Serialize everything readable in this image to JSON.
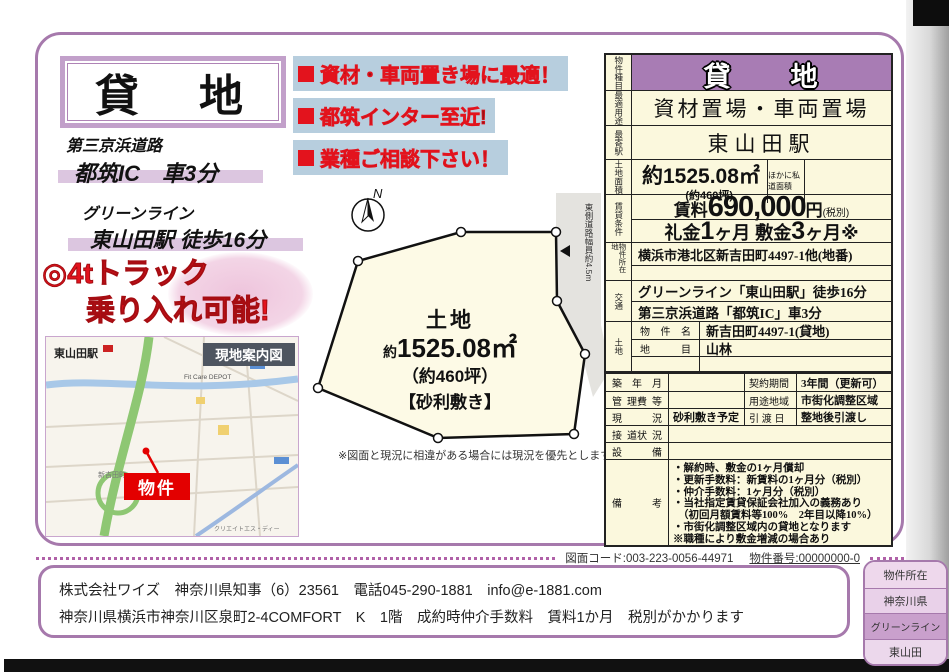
{
  "header": {
    "title": "貸　地"
  },
  "bullets": {
    "items": [
      "資材・車両置き場に最適！",
      "都筑インター至近!",
      "業種ご相談下さい！"
    ]
  },
  "access": {
    "road_line1": "第三京浜道路",
    "road_line2": "都筑IC　車3分",
    "rail_line1": "グリーンライン",
    "rail_line2": "東山田駅 徒歩16分",
    "truck_line1": "◎4tトラック",
    "truck_line2": "乗り入れ可能!"
  },
  "map": {
    "title": "現地案内図",
    "station": "東山田駅",
    "store": "Fit Care DEPOT",
    "area": "新吉田町",
    "poi": "クリエイトエス・ディー",
    "poi2": "オーケー",
    "marker": "物件"
  },
  "plot": {
    "north": "N",
    "name": "土地",
    "area_prefix": "約",
    "area_value": "1525.08㎡",
    "tsubo": "（約460坪）",
    "surface": "【砂利敷き】",
    "road_label": "東側道路幅員約4.5m",
    "note": "※図面と現況に相違がある場合には現況を優先とします。"
  },
  "table": {
    "type_label": "物件種目",
    "type_value": "貸　　地",
    "use_label": "最適用途",
    "use_value": "資材置場・車両置場",
    "station_label": "最寄駅",
    "station_value": "東山田駅",
    "area_label": "土地面積",
    "area_value": "約1525.08㎡",
    "area_tsubo": "(約460坪)",
    "area_other": "ほかに私道面積",
    "rent_label": "賃貸条件",
    "rent_prefix": "賃料",
    "rent_amount": "690,000",
    "rent_unit": "円",
    "rent_tax": "(税別)",
    "key_label": "礼金",
    "key_num": "1",
    "key_unit": "ヶ月",
    "deposit_label": "敷金",
    "deposit_num": "3",
    "deposit_unit": "ヶ月※",
    "location_label": "物件所在地",
    "location_value": "横浜市港北区新吉田町4497-1他(地番)",
    "traffic_label": "交通",
    "traffic_line1": "グリーンライン「東山田駅」徒歩16分",
    "traffic_line2": "第三京浜道路「都筑IC」車3分",
    "land_label": "土地",
    "land_name_label1": "物",
    "land_name_label2": "件",
    "land_name_label3": "名",
    "land_name_value": "新吉田町4497-1(貸地)",
    "land_cat_label1": "地",
    "land_cat_label2": "目",
    "land_cat_value": "山林",
    "built_label1": "築",
    "built_label2": "年",
    "built_label3": "月",
    "built_value": "",
    "contract_label": "契約期間",
    "contract_value": "3年間（更新可）",
    "mgmt_label1": "管",
    "mgmt_label2": "理費",
    "mgmt_label3": "等",
    "mgmt_value": "",
    "zoning_label": "用途地域",
    "zoning_value": "市街化調整区域",
    "current_label1": "現",
    "current_label2": "況",
    "current_value": "砂利敷き予定",
    "handover_label": "引 渡 日",
    "handover_value": "整地後引渡し",
    "road_label1": "接",
    "road_label2": "道状",
    "road_label3": "況",
    "road_value": "",
    "equip_label1": "設",
    "equip_label2": "備",
    "equip_value": "",
    "remarks_label1": "備",
    "remarks_label2": "考",
    "remarks": [
      "・解約時、敷金の1ヶ月償却",
      "・更新手数料：新賃料の1ヶ月分（税別）",
      "・仲介手数料：1ヶ月分（税別）",
      "・当社指定賃貸保証会社加入の義務あり",
      "（初回月額賃料等100%　2年目以降10%）",
      "・市街化調整区域内の貸地となります",
      "※職種により敷金増減の場合あり"
    ]
  },
  "meta": {
    "drawing_code": "図面コード:003-223-0056-44971",
    "property_no": "物件番号:00000000-0"
  },
  "company": {
    "line1": "株式会社ワイズ　神奈川県知事（6）23561　電話045-290-1881　info@e-1881.com",
    "line2": "神奈川県横浜市神奈川区泉町2-4COMFORT　K　1階　成約時仲介手数料　賃料1か月　税別がかかります"
  },
  "badge": {
    "rows": [
      "物件所在",
      "神奈川県",
      "グリーンライン",
      "東山田"
    ]
  },
  "colors": {
    "frame_purple": "#a679ac",
    "header_purple": "#a87cb4",
    "cream": "#fbf8dd",
    "accent_red": "#e3131d",
    "highlight_blue": "#b7cede"
  }
}
